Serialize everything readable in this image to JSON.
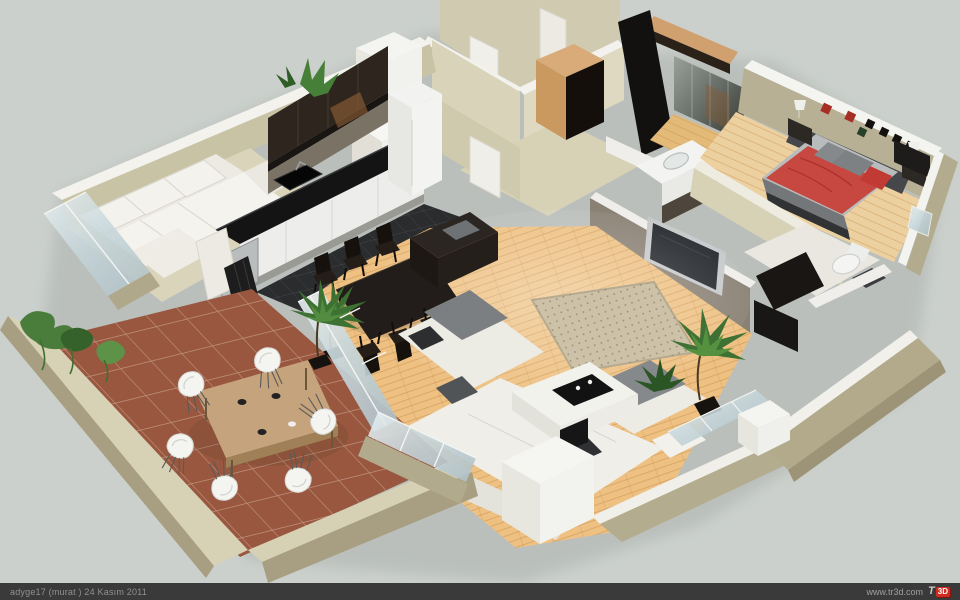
{
  "title": "3D apartment floor plan render",
  "footer": {
    "credit": "adyge17 (murat )  24 Kasım 2011",
    "website": "www.tr3d.com",
    "logo_t": "T",
    "logo_cube": "3D"
  },
  "palette": {
    "background": "#cbd0cc",
    "footer_bar": "#3a3a3b",
    "exterior_wall": "#b3ab8d",
    "wall_top": "#f3f2ed",
    "interior_wall": "#d8d3b9",
    "wood_floor": "#eec183",
    "kitchen_tile": "#2a2c2e",
    "terrace_tile": "#99573f",
    "sofa_white": "#efeee8",
    "cushion_gray": "#7d8184",
    "bed_red": "#c64840",
    "dark_furniture": "#221d1a",
    "plant_green": "#477b38",
    "rug_tan": "#cdc2a7",
    "glass": "#c9d6da",
    "logo_red": "#cf2b20"
  }
}
